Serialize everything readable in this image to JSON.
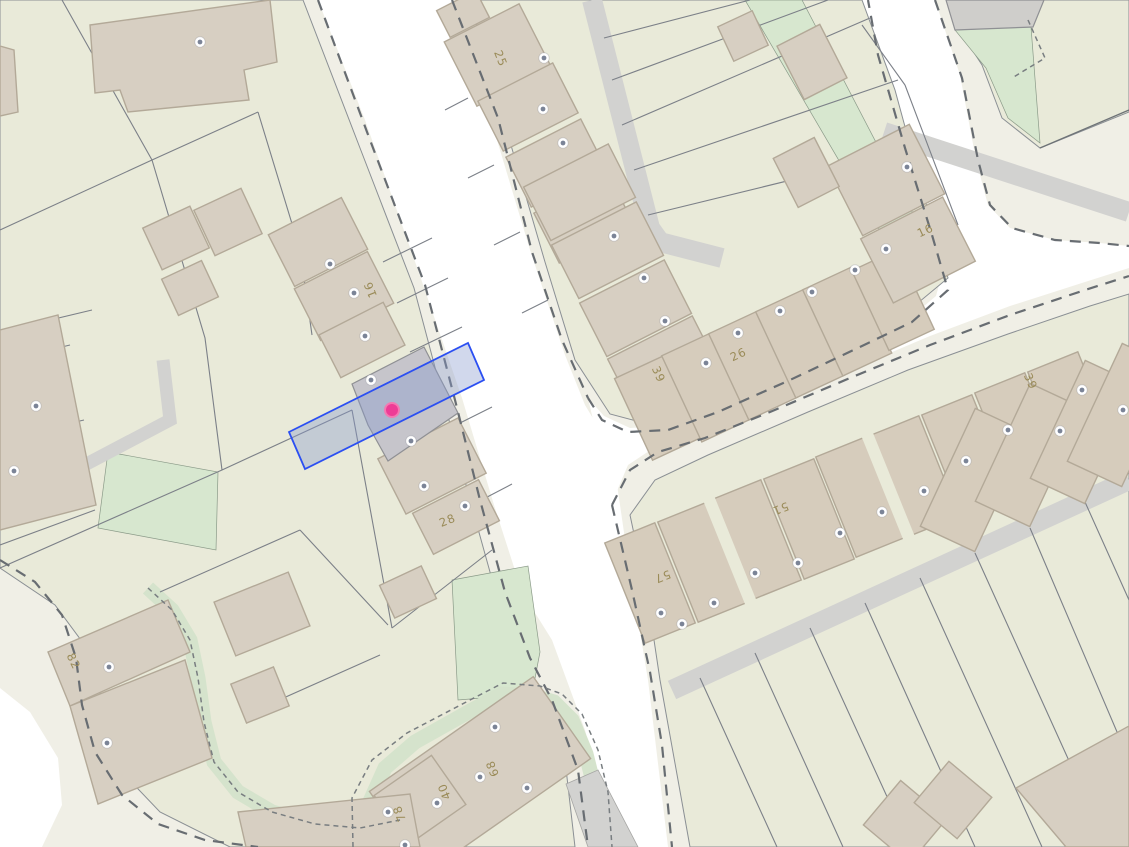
{
  "map": {
    "kind": "cadastral-property-map",
    "colors": {
      "road": "#ffffff",
      "verge": "#f0efe6",
      "parcel": "#e9ead9",
      "building": "#d7cfc2",
      "building_stroke": "#b3a998",
      "building_gray": "#cfcecb",
      "selected_building": "#c6c5cb",
      "green": "#d7e7cf",
      "path_gray": "#d2d2d0",
      "boundary_dash": "#686d72",
      "selection_stroke": "#2b4ff2",
      "selection_fill": "rgba(134,152,205,0.38)",
      "marker_pink": "#ee3c96",
      "marker_rim": "#f478b2",
      "entrance_dot": "#7b8497",
      "house_number_text": "#9a8b58"
    },
    "house_number_labels": [
      {
        "text": "25",
        "x": 497,
        "y": 60,
        "rotation": 68
      },
      {
        "text": "16",
        "x": 374,
        "y": 288,
        "rotation": -112
      },
      {
        "text": "28",
        "x": 449,
        "y": 524,
        "rotation": -22
      },
      {
        "text": "39",
        "x": 655,
        "y": 376,
        "rotation": 66
      },
      {
        "text": "26",
        "x": 740,
        "y": 358,
        "rotation": -25
      },
      {
        "text": "16",
        "x": 927,
        "y": 234,
        "rotation": -25
      },
      {
        "text": "39",
        "x": 1027,
        "y": 383,
        "rotation": 66
      },
      {
        "text": "57",
        "x": 661,
        "y": 573,
        "rotation": 158
      },
      {
        "text": "51",
        "x": 779,
        "y": 505,
        "rotation": 158
      },
      {
        "text": "82",
        "x": 70,
        "y": 663,
        "rotation": 64
      },
      {
        "text": "68",
        "x": 496,
        "y": 767,
        "rotation": -112
      },
      {
        "text": "40",
        "x": 448,
        "y": 790,
        "rotation": -112
      },
      {
        "text": "78",
        "x": 403,
        "y": 812,
        "rotation": -112
      }
    ],
    "entrance_dots": [
      {
        "x": 200,
        "y": 42
      },
      {
        "x": 544,
        "y": 58
      },
      {
        "x": 543,
        "y": 109
      },
      {
        "x": 563,
        "y": 143
      },
      {
        "x": 614,
        "y": 236
      },
      {
        "x": 644,
        "y": 278
      },
      {
        "x": 665,
        "y": 321
      },
      {
        "x": 706,
        "y": 363
      },
      {
        "x": 738,
        "y": 333
      },
      {
        "x": 780,
        "y": 311
      },
      {
        "x": 812,
        "y": 292
      },
      {
        "x": 855,
        "y": 270
      },
      {
        "x": 886,
        "y": 249
      },
      {
        "x": 907,
        "y": 167
      },
      {
        "x": 330,
        "y": 264
      },
      {
        "x": 354,
        "y": 293
      },
      {
        "x": 365,
        "y": 336
      },
      {
        "x": 371,
        "y": 380
      },
      {
        "x": 411,
        "y": 441
      },
      {
        "x": 424,
        "y": 486
      },
      {
        "x": 465,
        "y": 506
      },
      {
        "x": 36,
        "y": 406
      },
      {
        "x": 14,
        "y": 471
      },
      {
        "x": 661,
        "y": 613
      },
      {
        "x": 682,
        "y": 624
      },
      {
        "x": 714,
        "y": 603
      },
      {
        "x": 755,
        "y": 573
      },
      {
        "x": 798,
        "y": 563
      },
      {
        "x": 840,
        "y": 533
      },
      {
        "x": 882,
        "y": 512
      },
      {
        "x": 924,
        "y": 491
      },
      {
        "x": 966,
        "y": 461
      },
      {
        "x": 1008,
        "y": 430
      },
      {
        "x": 1060,
        "y": 431
      },
      {
        "x": 1082,
        "y": 390
      },
      {
        "x": 1123,
        "y": 410
      },
      {
        "x": 109,
        "y": 667
      },
      {
        "x": 107,
        "y": 743
      },
      {
        "x": 495,
        "y": 727
      },
      {
        "x": 480,
        "y": 777
      },
      {
        "x": 527,
        "y": 788
      },
      {
        "x": 437,
        "y": 803
      },
      {
        "x": 388,
        "y": 812
      },
      {
        "x": 405,
        "y": 845
      }
    ],
    "selection": {
      "points": "289,432 468,343 484,380 305,469"
    },
    "marker": {
      "x": 392,
      "y": 410,
      "radius": 7
    }
  }
}
